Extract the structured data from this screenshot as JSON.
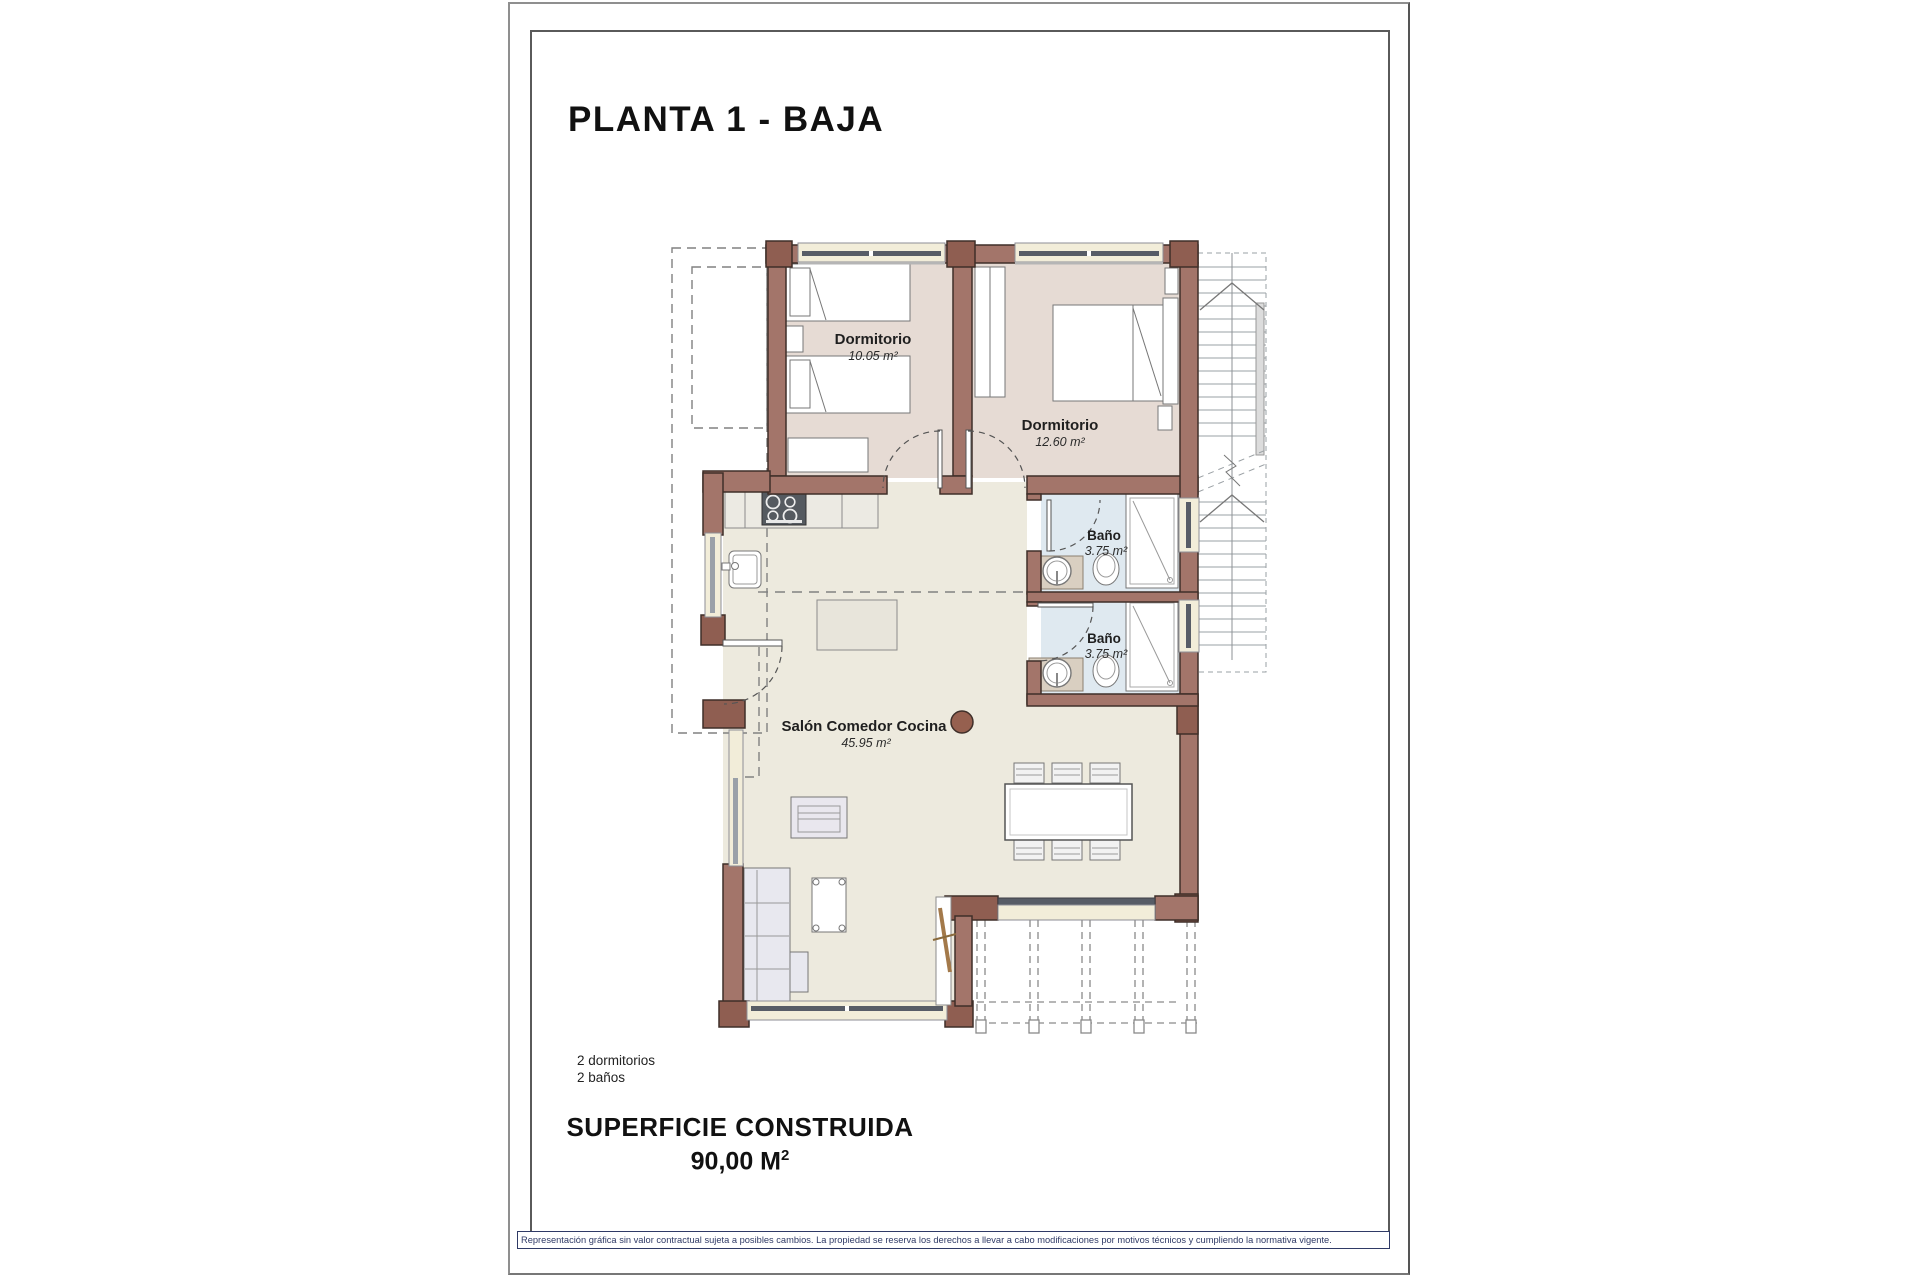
{
  "page": {
    "title": "PLANTA 1 - BAJA",
    "summary_line1": "2 dormitorios",
    "summary_line2": "2 baños",
    "surface_label": "SUPERFICIE CONSTRUIDA",
    "surface_value": "90,00 M",
    "surface_exponent": "2",
    "disclaimer": "Representación gráfica sin valor contractual sujeta a posibles cambios. La propiedad se reserva los derechos a llevar a cabo modificaciones por motivos técnicos y cumpliendo la normativa vigente."
  },
  "rooms": [
    {
      "name": "Dormitorio",
      "area": "10.05 m²"
    },
    {
      "name": "Dormitorio",
      "area": "12.60 m²"
    },
    {
      "name": "Baño",
      "area": "3.75 m²"
    },
    {
      "name": "Baño",
      "area": "3.75 m²"
    },
    {
      "name": "Salón Comedor Cocina",
      "area": "45.95 m²"
    }
  ],
  "colors": {
    "wall": "#a3756a",
    "wall_dark": "#8f5e51",
    "wall_stroke": "#3f2f29",
    "floor_bedroom": "#e6dbd4",
    "floor_living": "#edeade",
    "floor_bath": "#dfe9f0",
    "window_cream": "#f2edd9",
    "glazing": "#575c66",
    "disclaimer_navy": "#2f3a66"
  }
}
